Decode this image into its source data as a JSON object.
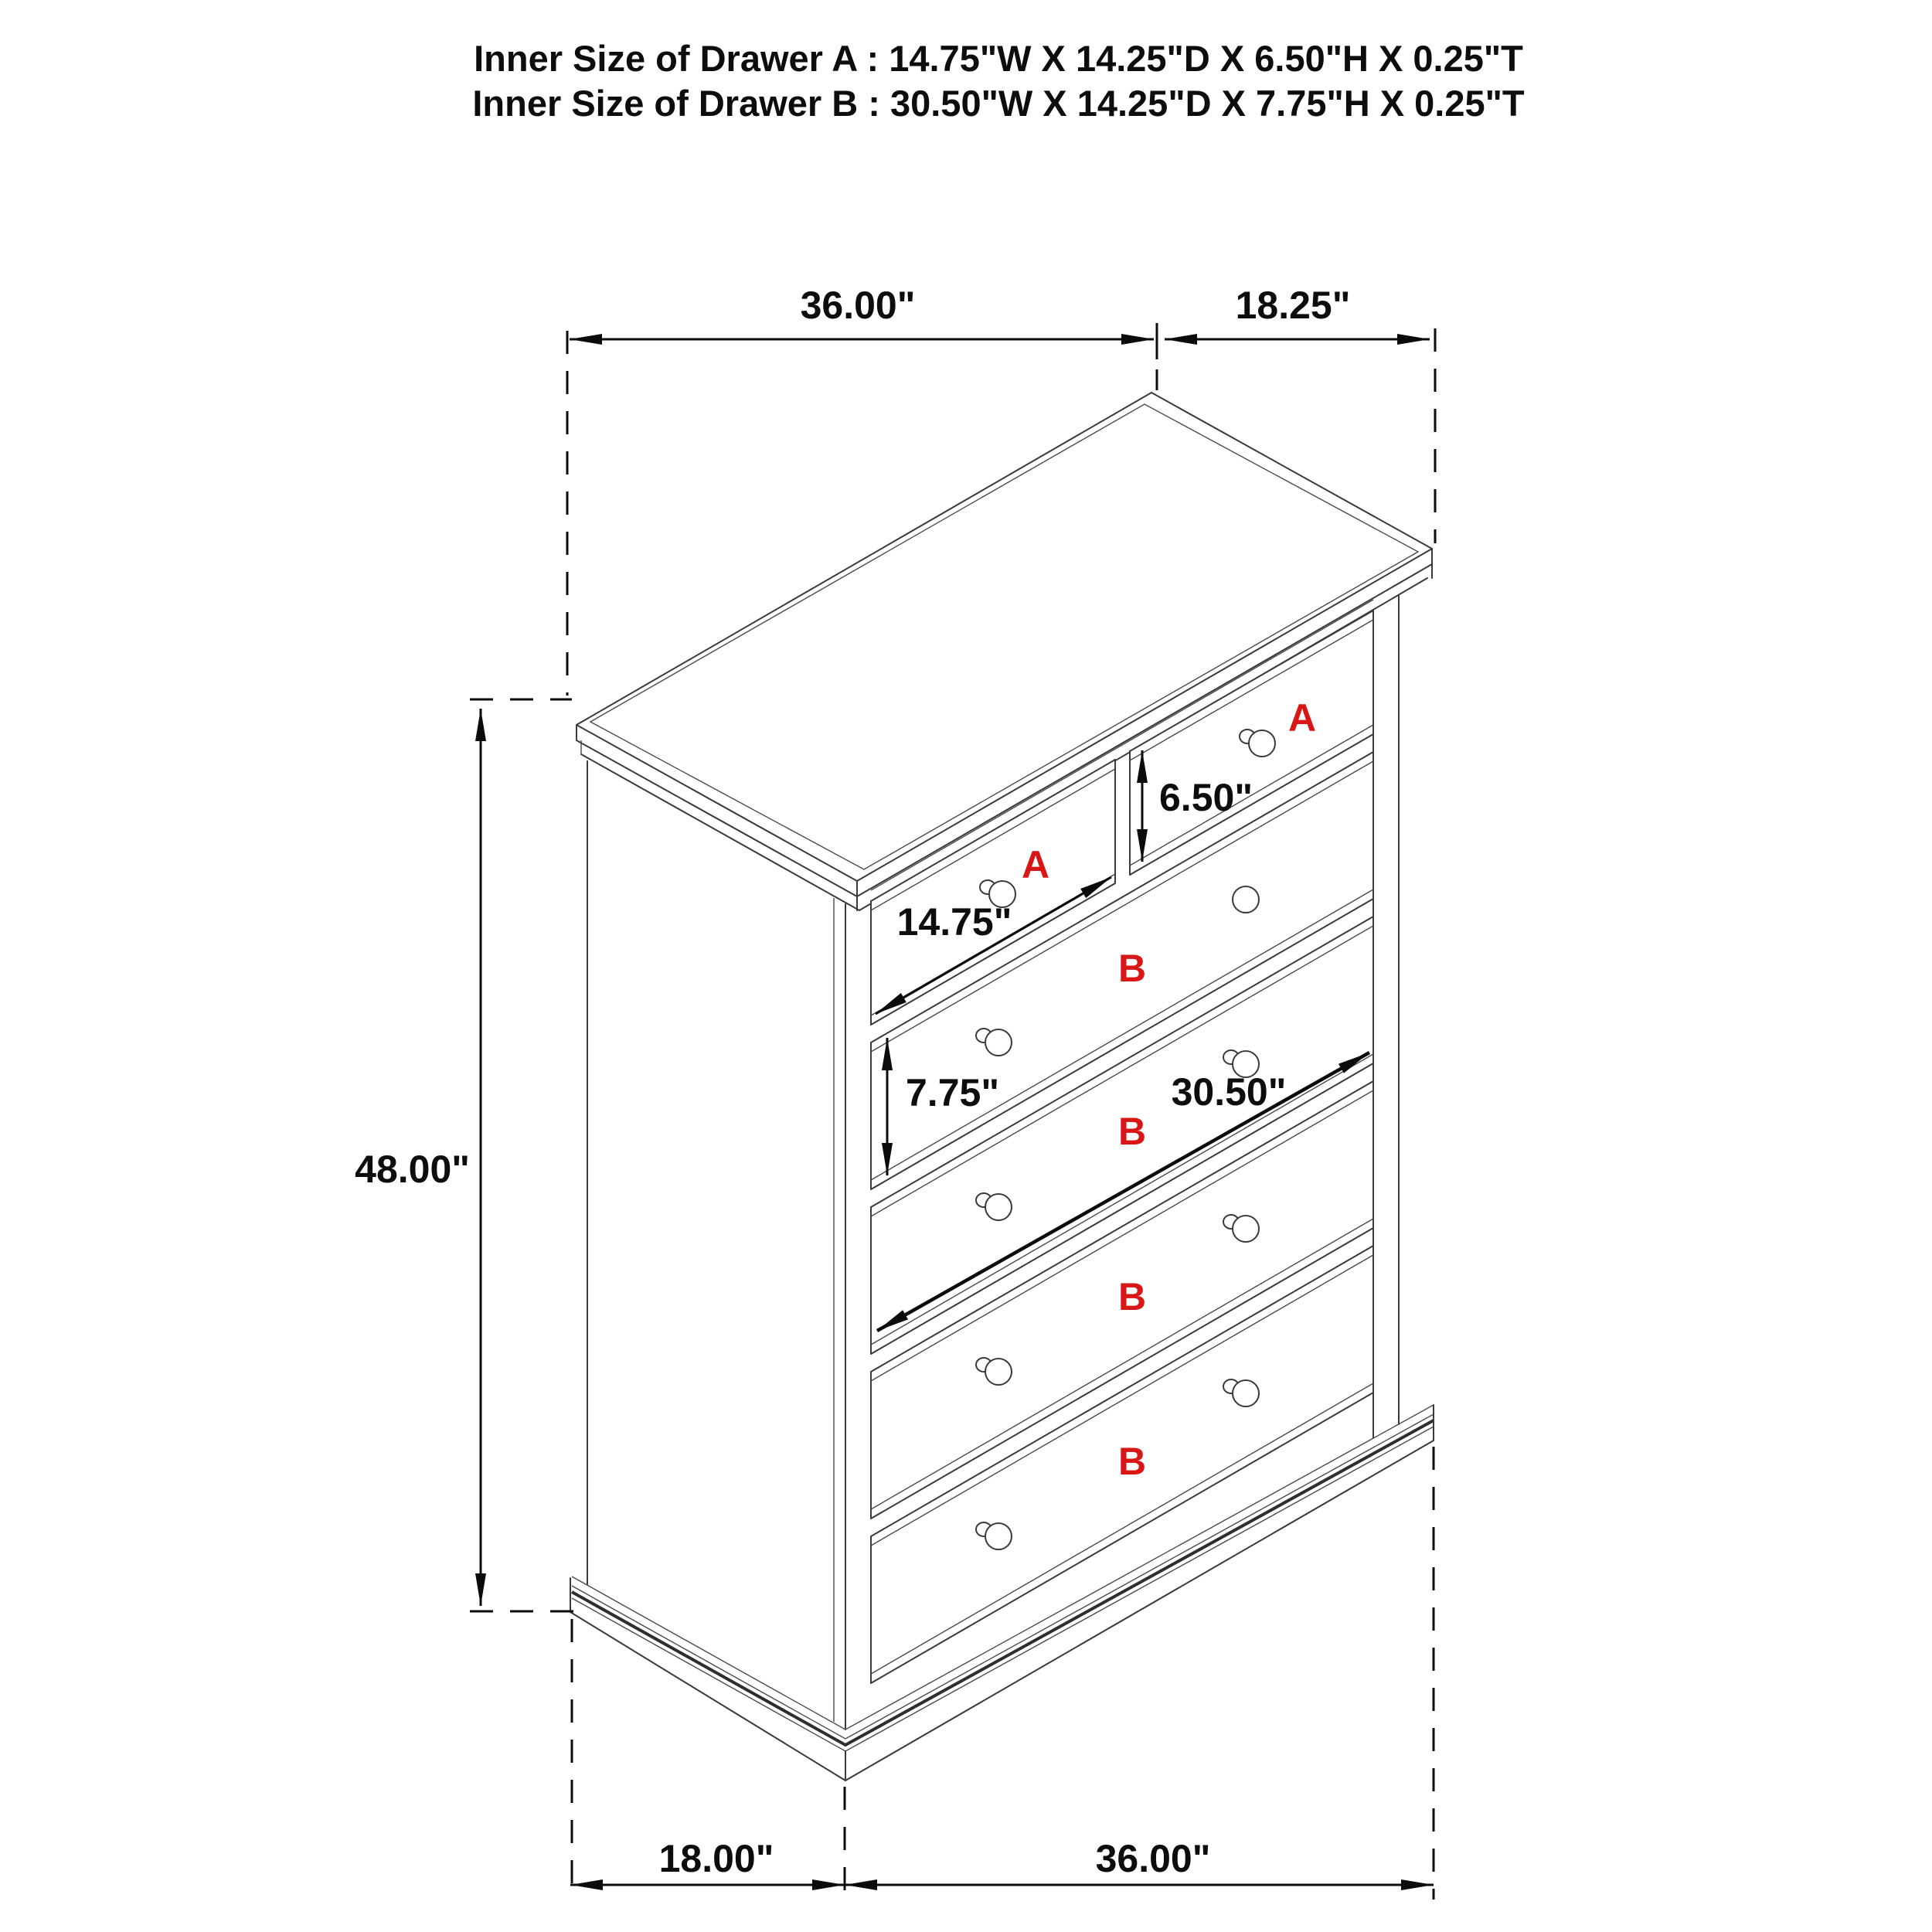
{
  "title": {
    "line_a": "Inner Size of Drawer A : 14.75\"W X 14.25\"D X 6.50\"H X 0.25\"T",
    "line_b": "Inner Size of Drawer B : 30.50\"W X 14.25\"D X 7.75\"H X 0.25\"T"
  },
  "dimensions": {
    "top_width": "36.00\"",
    "top_depth": "18.25\"",
    "overall_height": "48.00\"",
    "drawer_a_height": "6.50\"",
    "drawer_a_width": "14.75\"",
    "drawer_b_height": "7.75\"",
    "drawer_b_width": "30.50\"",
    "bottom_depth": "18.00\"",
    "bottom_width": "36.00\""
  },
  "drawer_labels": {
    "a1": "A",
    "a2": "A",
    "b1": "B",
    "b2": "B",
    "b3": "B",
    "b4": "B"
  },
  "colors": {
    "label_red": "#d91616",
    "cabinet_line": "#3a3a3a",
    "dimension_line": "#0b0b0b",
    "background": "#ffffff"
  }
}
